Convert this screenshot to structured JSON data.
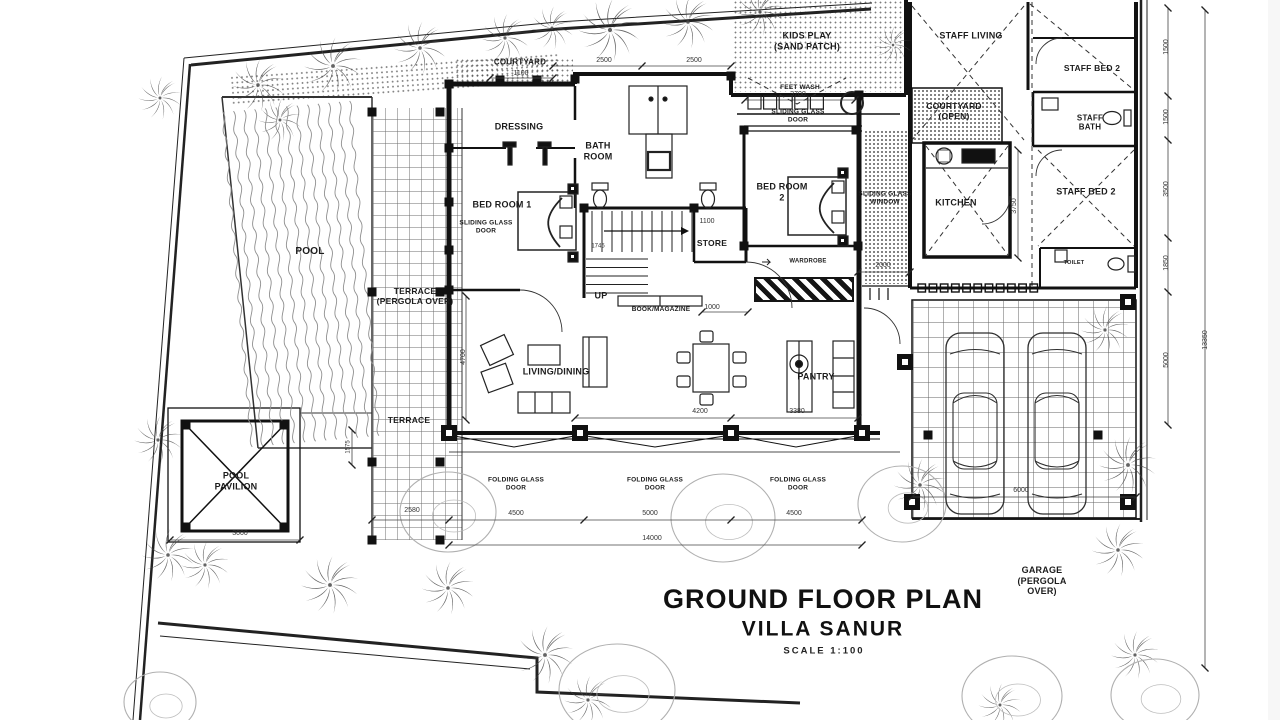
{
  "drawing": {
    "title": "GROUND FLOOR PLAN",
    "subtitle": "VILLA SANUR",
    "scale": "SCALE 1:100"
  },
  "rooms": {
    "pool": "POOL",
    "pool_pavilion": "POOL\nPAVILION",
    "terrace_pergola": "TERRACE\n(PERGOLA OVER)",
    "terrace": "TERRACE",
    "courtyard": "COURTYARD",
    "dressing": "DRESSING",
    "bath_room": "BATH\nROOM",
    "bed_room_1": "BED ROOM 1",
    "bed_room_2": "BED ROOM\n2",
    "store": "STORE",
    "stairs_up": "UP",
    "kids_play": "KIDS PLAY\n(SAND PATCH)",
    "feet_wash": "FEET WASH",
    "staff_living": "STAFF LIVING",
    "staff_bed_2_upper": "STAFF BED 2",
    "staff_bath": "STAFF\nBATH",
    "courtyard_open": "COURTYARD\n(OPEN)",
    "kitchen": "KITCHEN",
    "staff_bed_2_lower": "STAFF BED 2",
    "toilet": "TOILET",
    "living_dining": "LIVING/DINING",
    "pantry": "PANTRY",
    "garage": "GARAGE\n(PERGOLA\nOVER)"
  },
  "annotations": {
    "sliding_glass_door": "SLIDING GLASS\nDOOR",
    "sliding_glass_window": "SLIDING GLASS\nWINDOW",
    "folding_glass_door": "FOLDING GLASS\nDOOR",
    "wardrobe": "WARDROBE",
    "book_magazine": "BOOK/MAGAZINE"
  },
  "dimensions": {
    "courtyard_width": "1100",
    "bath_bay_left": "2500",
    "bath_bay_right": "2500",
    "bed2_door": "3700",
    "store_width": "1100",
    "book_shelf": "1000",
    "bed1_wall": "1745",
    "wardrobe_width": "2000",
    "living_width": "4200",
    "pantry_width": "3380",
    "kitchen_height": "3750",
    "terrace_height": "4700",
    "terrace_step": "1575",
    "bay_1": "4500",
    "bay_2": "5000",
    "bay_3": "4500",
    "front_total": "14000",
    "side_offset": "2580",
    "pavilion_width": "3000",
    "garage_width": "6000",
    "right_1": "1500",
    "right_2": "1500",
    "right_3": "3500",
    "right_4": "1850",
    "right_5": "5000",
    "right_total": "13350"
  },
  "colors": {
    "ink": "#1a1a1a",
    "dim_line": "#444444",
    "vegetation": "#8a8a8a",
    "paper": "#ffffff"
  }
}
